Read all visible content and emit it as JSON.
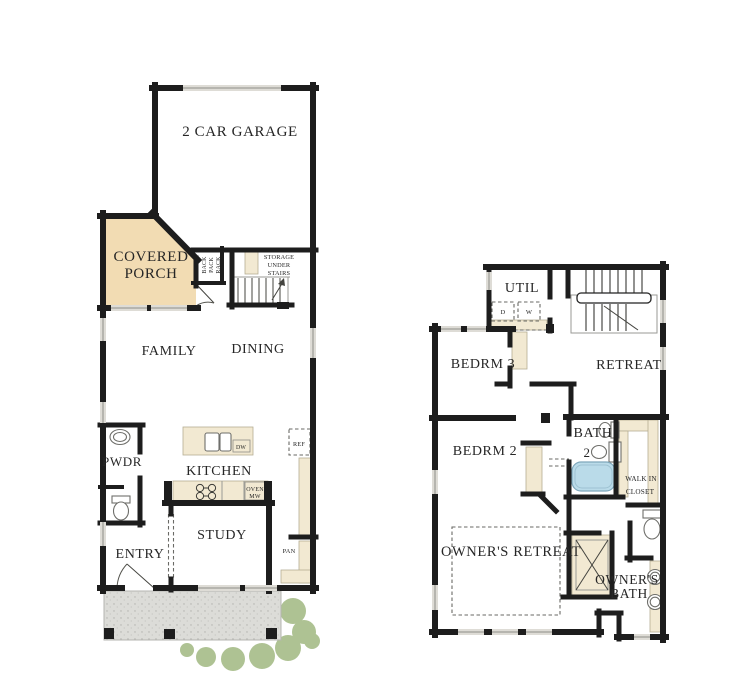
{
  "first_floor": {
    "garage": "2 CAR GARAGE",
    "covered_porch": {
      "line1": "COVERED",
      "line2": "PORCH"
    },
    "back_rack": {
      "line1": "BACK",
      "line2": "PACK",
      "line3": "RACK"
    },
    "storage": {
      "line1": "STORAGE",
      "line2": "UNDER",
      "line3": "STAIRS"
    },
    "family": "FAMILY",
    "dining": "DINING",
    "pwdr": "PWDR",
    "kitchen": "KITCHEN",
    "island_dw": "DW",
    "ref": "REF",
    "oven": {
      "line1": "OVEN",
      "line2": "MW"
    },
    "pan": "PAN",
    "study": "STUDY",
    "entry": "ENTRY"
  },
  "second_floor": {
    "util": "UTIL",
    "dryer": "D",
    "washer": "W",
    "bedrm3": "BEDRM 3",
    "retreat": "RETREAT",
    "bedrm2": "BEDRM 2",
    "bath2": {
      "line1": "BATH",
      "line2": "2"
    },
    "walk_in_closet": {
      "line1": "WALK IN",
      "line2": "CLOSET"
    },
    "owners_retreat": "OWNER'S RETREAT",
    "owners_bath": {
      "line1": "OWNER'S",
      "line2": "BATH"
    }
  },
  "colors": {
    "wall": "#1d1d1d",
    "porch_fill": "#f2dcb3",
    "counter_fill": "#f2e9d2",
    "tub_fill": "#badbe9",
    "shrub_fill": "#aec293",
    "concrete_fill": "#dcdcd8"
  }
}
